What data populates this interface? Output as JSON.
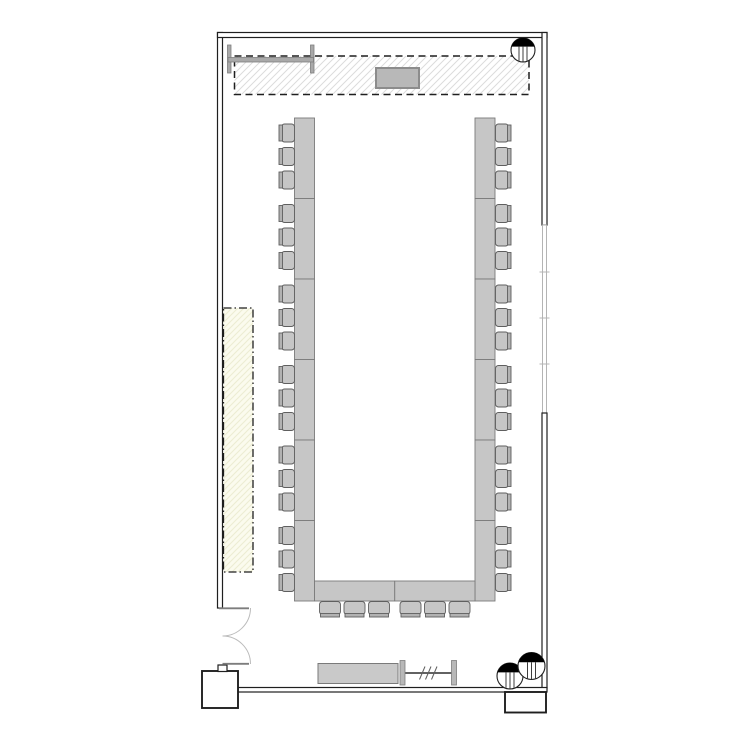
{
  "page": {
    "type": "architectural-floor-plan",
    "room": "conference-room-u-shape-setup"
  },
  "colors": {
    "wall_stroke": "#1f1f1f",
    "window_stroke": "#b4b4b4",
    "table_fill": "#c6c6c6",
    "table_stroke": "#7a7a7a",
    "chair_fill": "#c6c6c6",
    "chair_back_fill": "#b2b2b2",
    "chair_stroke": "#5f5f5f",
    "hatch_gray": "#dcdcdc",
    "service_fill": "#fbfbee",
    "service_hatch": "#ececd2",
    "podium_fill": "#b8b8b8",
    "podium_stroke": "#8c8c8c",
    "screen_fill": "#a9a9a9",
    "credenza_fill": "#c9c9c9",
    "door_arc": "#bbbbbb",
    "marker_fill": "#000000"
  },
  "inventory": {
    "chairs": {
      "left_column": 18,
      "right_column": 18,
      "bottom_row": 6,
      "chairs_per_group": 3,
      "total": 42
    },
    "table_segments": {
      "left": 6,
      "right": 6,
      "bottom": 2
    },
    "column_markers": 3,
    "areas": [
      "stage-area-dashed-hatched",
      "service-area-dash-dot-cream"
    ],
    "equipment": [
      "projection-screen",
      "podium",
      "credenza",
      "partition-rail",
      "double-swing-door"
    ],
    "window_mullions": 3
  }
}
